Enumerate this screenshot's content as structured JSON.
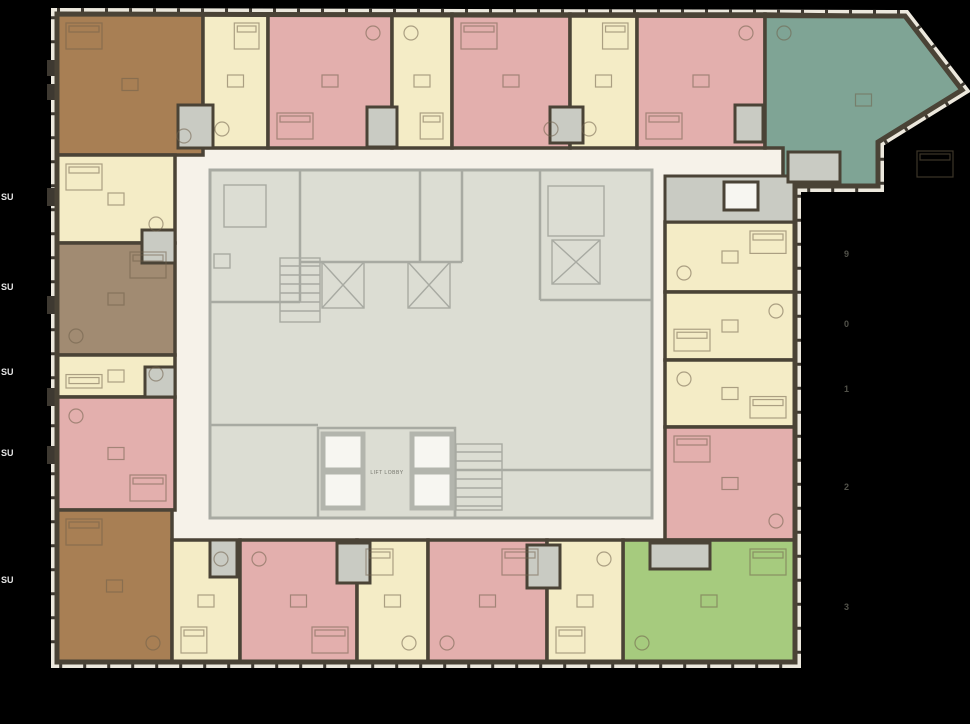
{
  "palette": {
    "background": "#000000",
    "wall": "#4a4336",
    "window_band": "#ece8dd",
    "corridor": "#f6f2e9",
    "core_fill": "#dcddd3",
    "core_wall": "#a8aaa2",
    "vestibule": "#c9cbc3",
    "shaft_white": "#f7f6f1",
    "unit_brown": "#a87f54",
    "unit_taupe": "#a18b72",
    "unit_cream": "#f4ecc6",
    "unit_pink": "#e3afad",
    "unit_teal": "#7fa495",
    "unit_green": "#a6cb7e"
  },
  "labels": {
    "lift_lobby": "LIFT LOBBY",
    "left_edge": [
      "SU",
      "SU",
      "SU",
      "SU",
      "SU"
    ],
    "right_edge": [
      "9",
      "0",
      "1",
      "2",
      "3"
    ]
  }
}
